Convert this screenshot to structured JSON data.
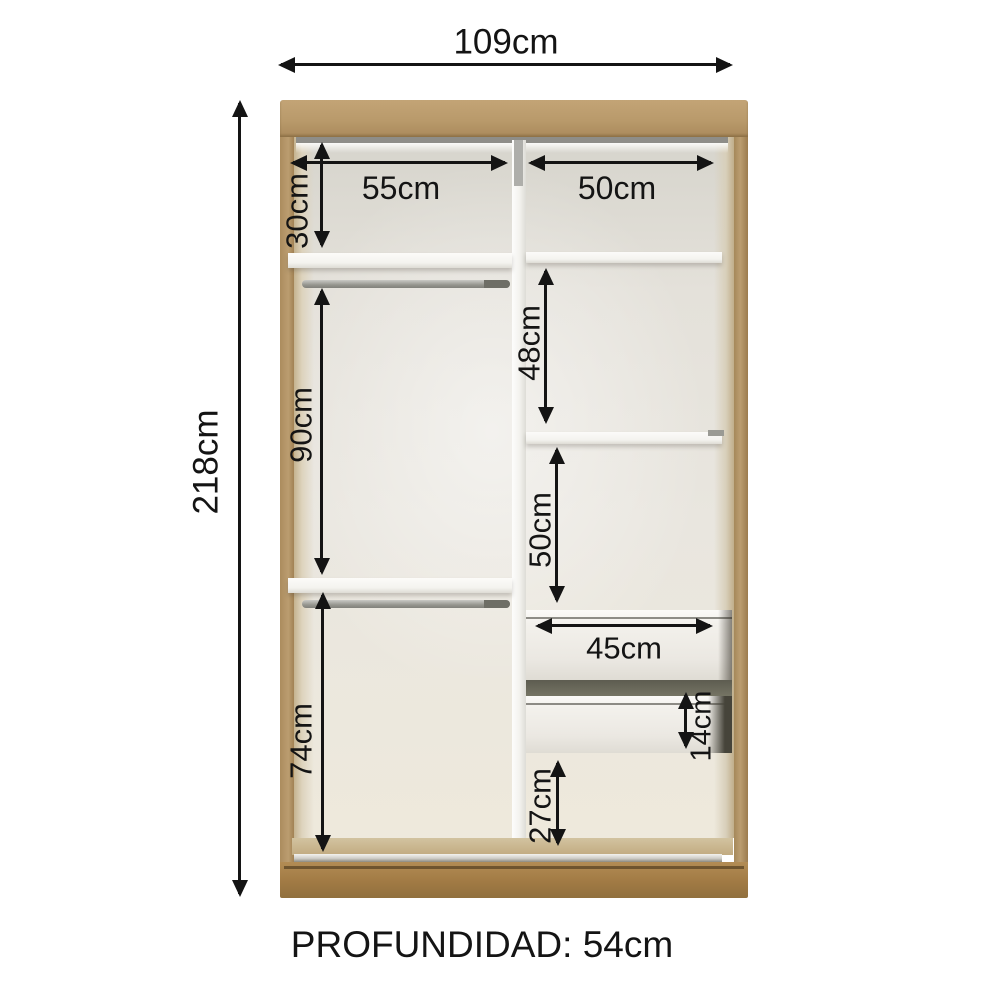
{
  "page": {
    "background": "#ffffff"
  },
  "wardrobe": {
    "overall": {
      "width_label": "109cm",
      "height_label": "218cm"
    },
    "sections": {
      "top_shelf_height": "30cm",
      "left_column_width": "55cm",
      "right_column_width": "50cm",
      "left_hanging_upper": "90cm",
      "right_gap_upper": "48cm",
      "right_gap_lower": "50cm",
      "drawer_width": "45cm",
      "drawer_front_height": "14cm",
      "left_hanging_lower": "74cm",
      "base_gap_height": "27cm"
    },
    "colors": {
      "wood": "#b3935f",
      "wood_base": "#a17a44",
      "interior": "#e7e4dc",
      "shelf": "#f6f5f1",
      "dimension_line": "#141414"
    }
  },
  "footer": {
    "depth_label": "PROFUNDIDAD: 54cm"
  }
}
